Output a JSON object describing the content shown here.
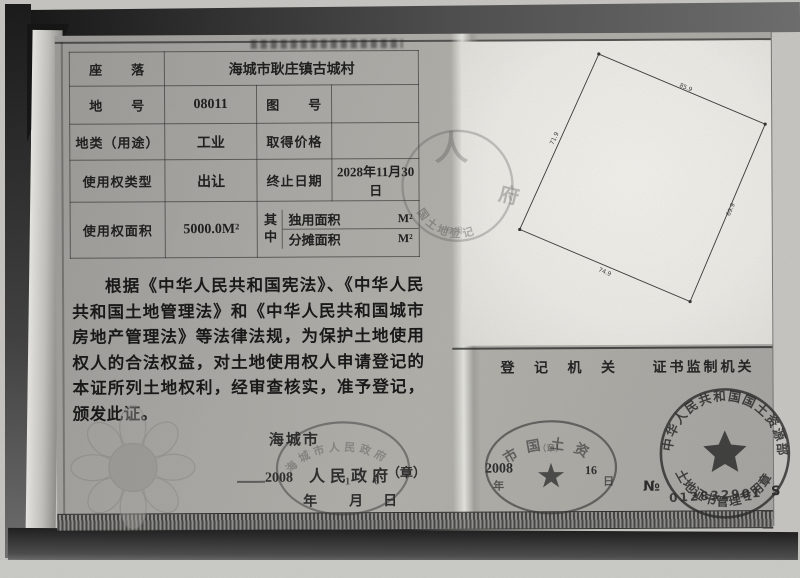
{
  "table": {
    "location_label": "座　　落",
    "location_value": "海城市耿庄镇古城村",
    "parcel_label": "地　　号",
    "parcel_value": "08011",
    "map_label": "图　　号",
    "map_value": "",
    "class_label": "地类（用途）",
    "class_value": "工业",
    "price_label": "取得价格",
    "price_value": "",
    "tenure_label": "使用权类型",
    "tenure_value": "出让",
    "expiry_label": "终止日期",
    "expiry_value_line1": "2028年11月30",
    "expiry_value_line2": "日",
    "area_label": "使用权面积",
    "area_value": "5000.0M²",
    "among_label": "其中",
    "exclusive_label": "独用面积",
    "exclusive_unit": "M²",
    "apportioned_label": "分摊面积",
    "apportioned_unit": "M²"
  },
  "declaration": "根据《中华人民共和国宪法》、《中华人民共和国土地管理法》和《中华人民共和国城市房地产管理法》等法律法规，为保护土地使用权人的合法权益，对土地使用权人申请登记的本证所列土地权利，经审查核实，准予登记，颁发此证。",
  "issuer": {
    "city": "海城市",
    "government": "人民政府",
    "seal_mark": "（章）",
    "year_value": "2008",
    "day_digits": "16",
    "year": "年",
    "month": "月",
    "day": "日",
    "stamp_arc": "海城市人民政府"
  },
  "sections": {
    "registry_title": "登 记 机 关",
    "supervisor_title": "证书监制机关"
  },
  "middle_seal": {
    "char_top": "人",
    "char_right": "府",
    "arc_text": "国土地登记",
    "sub_text": "专用"
  },
  "registry_stamp": {
    "arc_text": "市国土资",
    "seal_mark": "（章）",
    "year_value": "2008",
    "year": "年",
    "day_value": "16",
    "day": "日"
  },
  "supervisor_stamp": {
    "arc_top": "中华人民共和国国土资源部",
    "arc_bottom": "土地证书管理专用章",
    "serial_label": "№",
    "serial_value": "012832901",
    "serial_suffix": "S"
  },
  "diagram": {
    "side_labels": {
      "top": "85.9",
      "right": "69.9",
      "bottom": "74.9",
      "left": "71.9"
    }
  },
  "colors": {
    "paper_gray": "#a9a8a4",
    "panel_white": "#edece7",
    "ink": "#1d1d1d",
    "stamp_ink": "#2e2e2e"
  }
}
